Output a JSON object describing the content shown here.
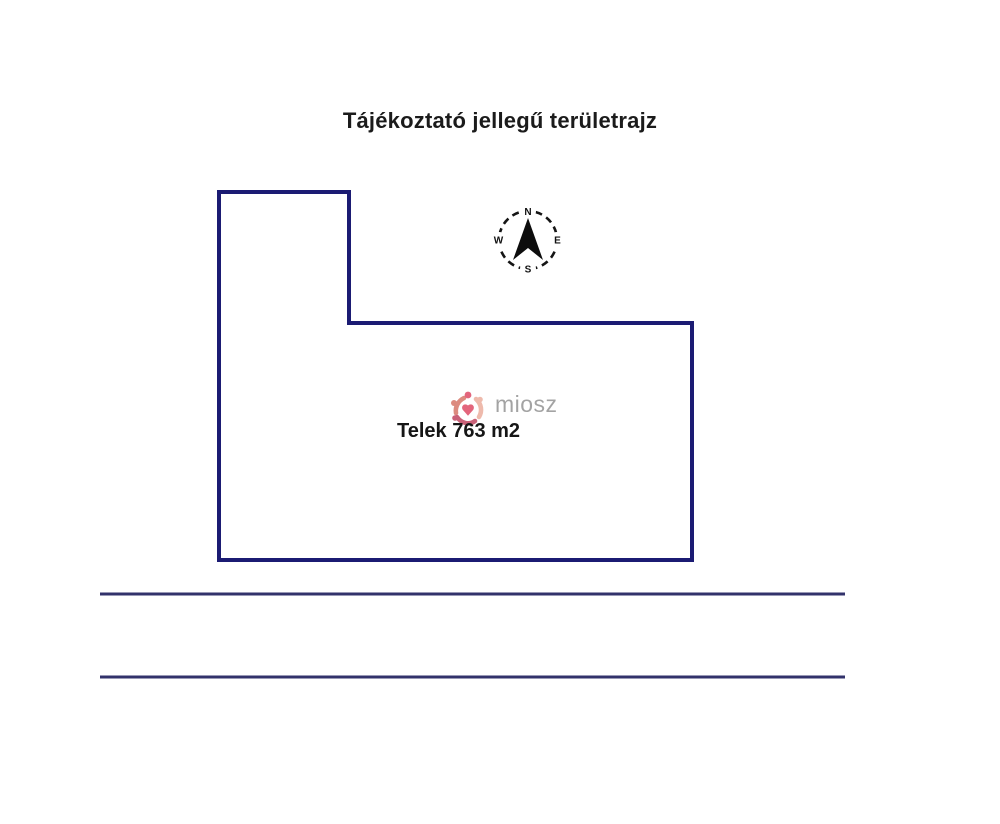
{
  "page": {
    "title": "Tájékoztató jellegű területrajz",
    "background_color": "#ffffff"
  },
  "plot": {
    "area_label": "Telek 763 m2",
    "outline_color": "#1b1b73",
    "outline_points": "219,192 349,192 349,323 692,323 692,560 219,560"
  },
  "compass": {
    "north_label": "N",
    "east_label": "E",
    "south_label": "S",
    "west_label": "W",
    "ring_color": "#151515",
    "needle_color": "#0d0d0d"
  },
  "road": {
    "line_color": "#32326b"
  },
  "watermark": {
    "brand": "miosz",
    "text_color": "#9a9a9a",
    "logo_colors": [
      "#e0556e",
      "#d97f72",
      "#c4506a",
      "#edb3a4"
    ]
  }
}
